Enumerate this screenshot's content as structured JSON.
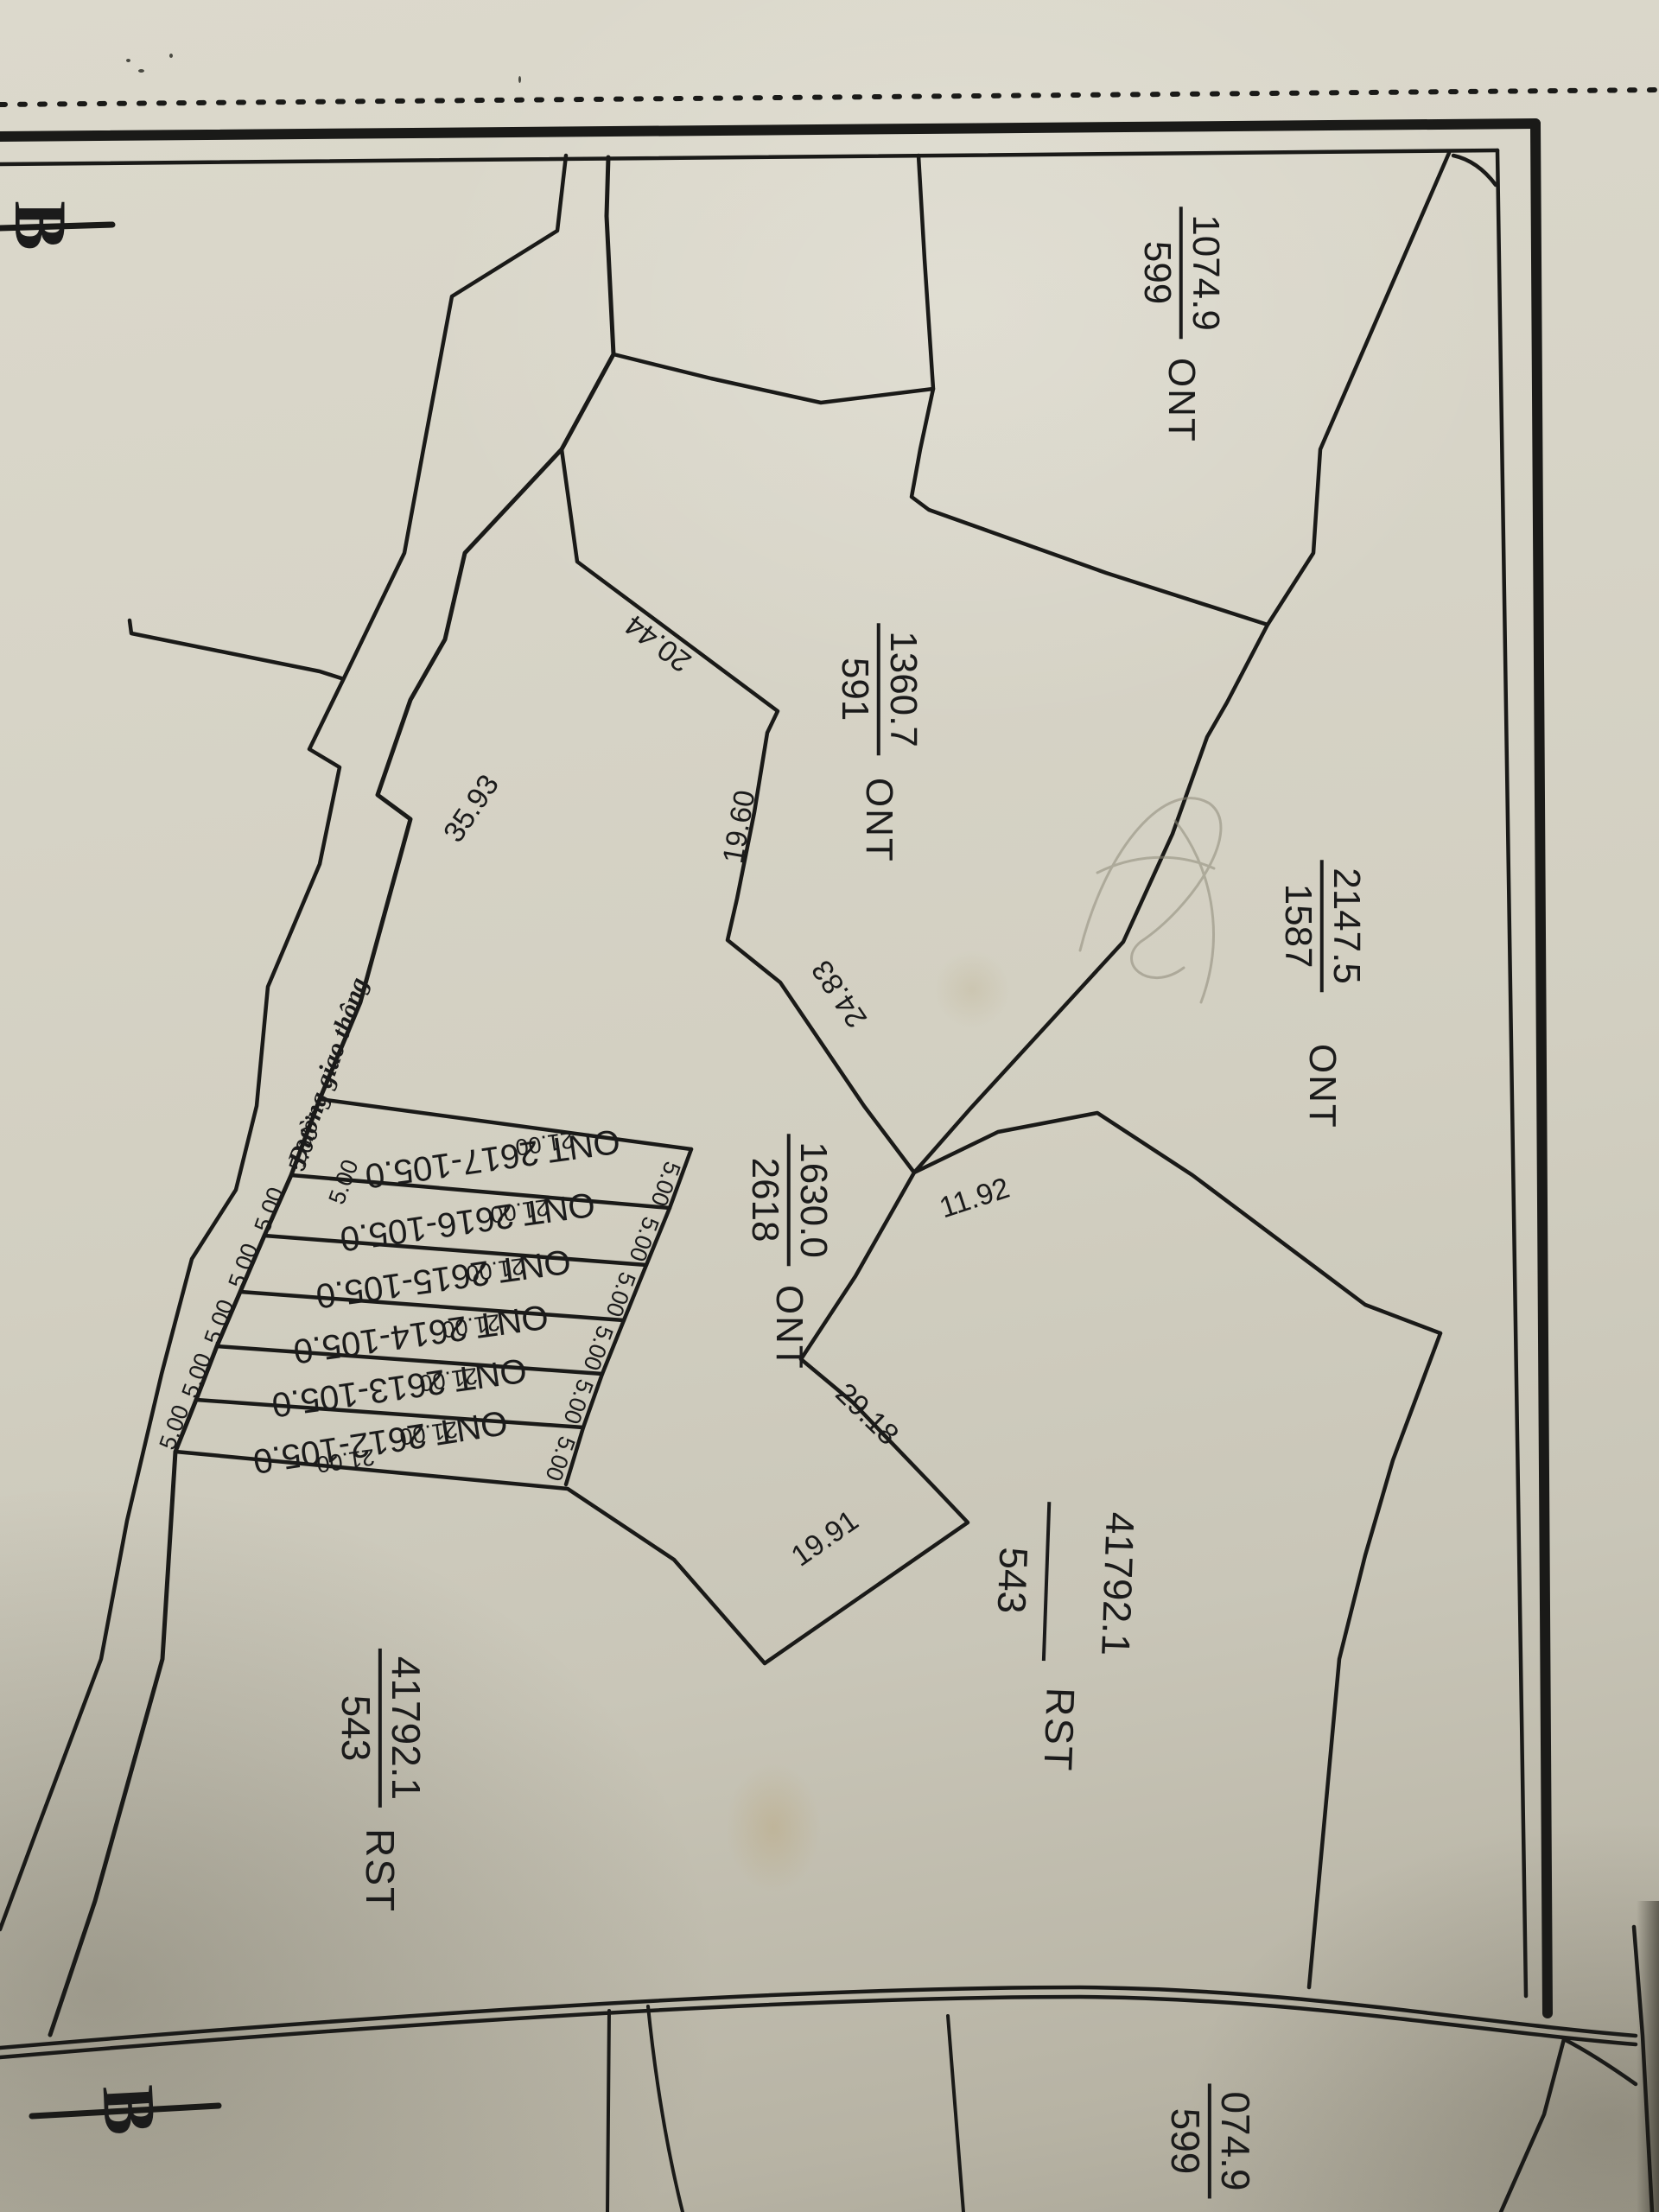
{
  "map": {
    "kind": "cadastral-parcel-map-scan"
  },
  "north": {
    "symbol": "B"
  },
  "road": {
    "name": "Đường giao thông"
  },
  "parcels": {
    "p599_top": {
      "code": "ONT",
      "number": "599",
      "area": "1074.9"
    },
    "p591": {
      "code": "ONT",
      "number": "591",
      "area": "1360.7"
    },
    "p2618": {
      "code": "ONT",
      "number": "2618",
      "area": "1630.0"
    },
    "p1587": {
      "code": "ONT",
      "number": "1587",
      "area": "2147.5"
    },
    "rst_left": {
      "code": "RST",
      "number": "543",
      "area": "41792.1"
    },
    "rst_right": {
      "code": "RST",
      "number": "543",
      "area": "41792.1"
    },
    "p599_bottom": {
      "code": "",
      "number": "599",
      "area": "074.9"
    }
  },
  "strip_parcels": [
    "ONT 2617-105.0",
    "ONT 2616-105.0",
    "ONT 2615-105.0",
    "ONT 2614-105.0",
    "ONT 2613-105.0",
    "ONT 2612-105.0"
  ],
  "dimensions": {
    "seg_2044": "20.44",
    "seg_3593": "35.93",
    "seg_1960": "19.60",
    "seg_2483": "24.83",
    "seg_1192": "11.92",
    "seg_2918": "29.18",
    "seg_1991": "19.91",
    "side": "21.00",
    "front": "5.00"
  },
  "colors": {
    "ink": "#1a1a18",
    "paper": "#d2cfc1"
  }
}
